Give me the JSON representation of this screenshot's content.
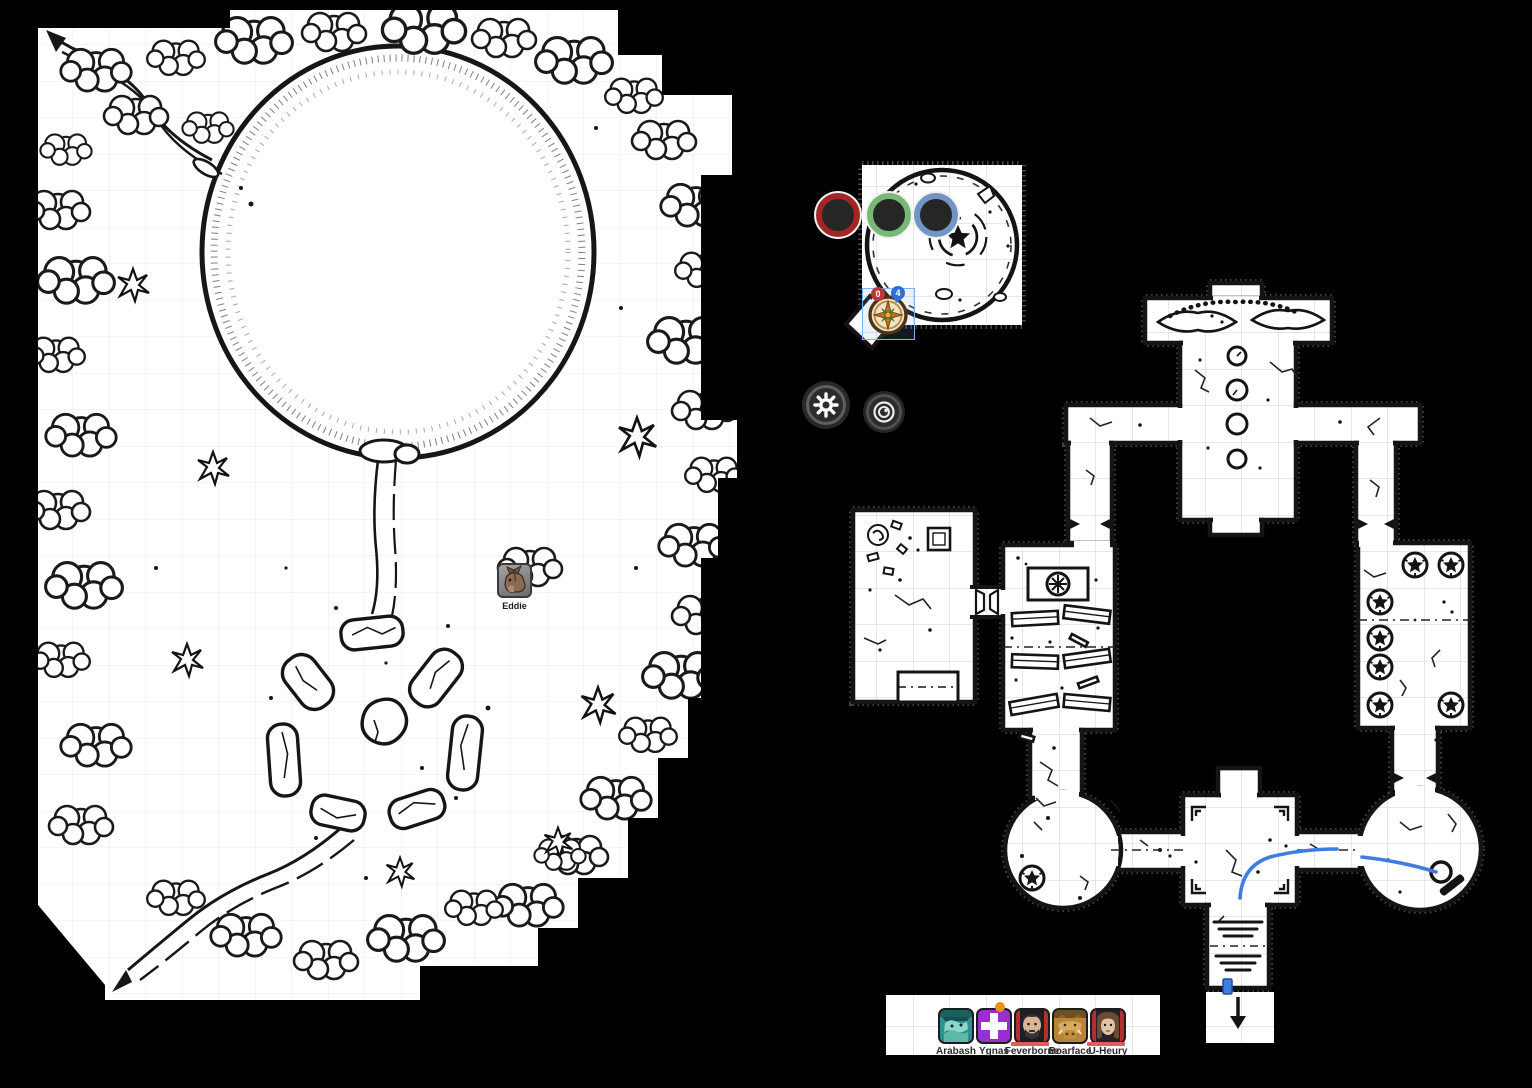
{
  "ui": {
    "ring_buttons": [
      {
        "id": "red-ring-token",
        "color": "#a32626"
      },
      {
        "id": "green-ring-token",
        "color": "#77b877"
      },
      {
        "id": "blue-ring-token",
        "color": "#7295c6"
      }
    ],
    "settings_button": {
      "icon": "gear-icon"
    },
    "capture_button": {
      "icon": "lens-icon"
    }
  },
  "tokens": {
    "eddie": {
      "label": "Eddie"
    },
    "compass": {
      "badge_left": "0",
      "badge_right": "4"
    }
  },
  "party": {
    "members": [
      {
        "name": "Arabash"
      },
      {
        "name": "Ygnas",
        "badge": "orange-dot"
      },
      {
        "name": "Feverborne",
        "hp_bar": true
      },
      {
        "name": "Boarface"
      },
      {
        "name": "U-Heury",
        "hp_bar": true
      }
    ]
  },
  "colors": {
    "background": "#000000",
    "selection": "#7fb0f2",
    "draw_path": "#3f7de0",
    "badge_red": "#c03434",
    "badge_blue": "#2f6fd6",
    "hp_bar": "#e05c5c",
    "ygnas_badge": "#e8920e"
  }
}
